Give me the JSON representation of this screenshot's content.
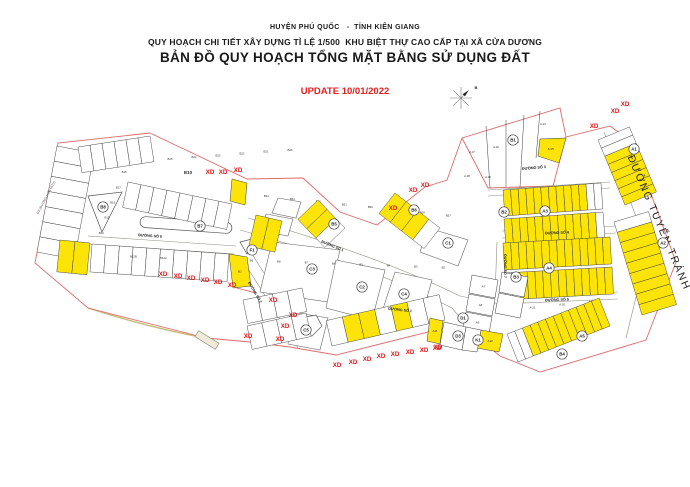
{
  "header": {
    "line1": "HUYỆN PHÚ QUỐC   -  TỈNH KIÊN GIANG",
    "line2": "QUY HOẠCH CHI TIẾT XÂY DỰNG TỈ LỆ 1/500  KHU BIỆT THỰ CAO CẤP TẠI XÃ CỬA DƯƠNG",
    "line3": "BẢN ĐỒ QUY HOẠCH TỔNG MẶT BẰNG SỬ DỤNG ĐẤT",
    "update": "UPDATE 10/01/2022"
  },
  "colors": {
    "boundary": "#e06a6a",
    "lot_stroke": "#3a3a3a",
    "yellow": "#fce408",
    "white_lot": "#ffffff",
    "xd": "#e01818",
    "road_edge": "#8f8f82",
    "update_red": "#e02020",
    "shore": "#c9bb78",
    "circle_stroke": "#444444",
    "label_dark": "#222222"
  },
  "map": {
    "boundaries": [
      "M150,133 L58,143 L35,263 L88,308 L206,338",
      "M206,338 L250,342 L290,347 L336,355 L448,327 L472,333 L500,356 L540,372 L646,340 L676,262 L632,142 L610,126",
      "M150,133 L247,179 L303,178 L340,212 L377,225 L425,187 L447,180 L462,138",
      "M462,138 L560,108 L566,137 L553,186 L488,188 L462,138",
      "M566,137 L610,126",
      "M233,287 L256,293"
    ],
    "shore": "M88,308 Q150,328 206,338",
    "road_edges": [
      "M88,236 L236,246",
      "M88,244 L234,254",
      "M248,218 C310,236 390,262 460,296",
      "M240,230 C305,248 382,272 452,308",
      "M488,190 L610,182",
      "M488,196 L610,188",
      "M502,231 L616,226",
      "M502,238 L616,233",
      "M500,297 L618,292",
      "M500,304 L618,299",
      "M240,256 L298,348",
      "M250,251 L308,342",
      "M497,242 L495,296",
      "M507,244 L505,298",
      "M604,132 L648,248 L626,338",
      "M460,296 L500,304",
      "M452,308 L470,330"
    ],
    "blocks": [
      {
        "pts": [
          [
            272,
            242
          ],
          [
            340,
            250
          ],
          [
            328,
            302
          ],
          [
            260,
            292
          ]
        ]
      },
      {
        "pts": [
          [
            336,
            260
          ],
          [
            385,
            270
          ],
          [
            372,
            320
          ],
          [
            326,
            308
          ]
        ]
      },
      {
        "pts": [
          [
            395,
            272
          ],
          [
            432,
            280
          ],
          [
            420,
            322
          ],
          [
            382,
            312
          ]
        ]
      },
      {
        "pts": [
          [
            428,
            228
          ],
          [
            468,
            240
          ],
          [
            458,
            266
          ],
          [
            420,
            252
          ]
        ]
      },
      {
        "pts": [
          [
            292,
            312
          ],
          [
            328,
            318
          ],
          [
            320,
            350
          ],
          [
            288,
            344
          ]
        ]
      },
      {
        "pts": [
          [
            278,
            198
          ],
          [
            301,
            202
          ],
          [
            296,
            218
          ],
          [
            272,
            213
          ]
        ]
      },
      {
        "pts": [
          [
            266,
            214
          ],
          [
            293,
            219
          ],
          [
            288,
            236
          ],
          [
            262,
            231
          ]
        ]
      }
    ],
    "islands": [
      {
        "pts": [
          [
            88,
            196
          ],
          [
            122,
            192
          ],
          [
            102,
            232
          ]
        ]
      },
      {
        "pts": [
          [
            240,
            242
          ],
          [
            252,
            239
          ],
          [
            247,
            254
          ]
        ]
      },
      {
        "pts": [
          [
            300,
            318
          ],
          [
            316,
            315
          ],
          [
            322,
            326
          ],
          [
            312,
            336
          ],
          [
            300,
            332
          ]
        ]
      }
    ],
    "oval_island": {
      "cx": 186,
      "cy": 225,
      "w": 92,
      "h": 11,
      "rot": 4
    },
    "pentagon_dividers": [
      [
        486,
        126,
        490,
        188
      ],
      [
        506,
        120,
        506,
        187
      ],
      [
        524,
        115,
        520,
        187
      ],
      [
        540,
        111,
        536,
        158
      ]
    ],
    "strips": [
      {
        "a": [
          57,
          146
        ],
        "b": [
          37,
          252
        ],
        "depth": -38,
        "count": 7,
        "yellows": [],
        "labels": [
          "B19",
          "B18",
          "B17",
          "B16",
          "B15",
          "B14",
          "B13"
        ]
      },
      {
        "a": [
          78,
          147
        ],
        "b": [
          150,
          136
        ],
        "depth": 26,
        "count": 6,
        "yellows": [],
        "labels": [
          "B25",
          "B24",
          "B23",
          "B22",
          "B21",
          "B20"
        ]
      },
      {
        "a": [
          128,
          182
        ],
        "b": [
          232,
          204
        ],
        "depth": 26,
        "count": 8,
        "yellows": [],
        "labels": [
          "B34",
          "B33",
          "B32",
          "B31",
          "B30",
          "B29",
          "B28",
          "B27"
        ]
      },
      {
        "a": [
          92,
          244
        ],
        "b": [
          229,
          254
        ],
        "depth": 28,
        "count": 10,
        "yellows": [],
        "labels": [
          "B11",
          "B10",
          "B9",
          "B8",
          "B7",
          "B6",
          "B5",
          "B4",
          "B3",
          "B2"
        ]
      },
      {
        "a": [
          60,
          240
        ],
        "b": [
          90,
          243
        ],
        "depth": 32,
        "count": 2,
        "yellows": [
          0,
          1
        ],
        "labels": [
          "B12B",
          "B12A"
        ]
      },
      {
        "a": [
          243,
          300
        ],
        "b": [
          302,
          288
        ],
        "depth": 24,
        "count": 4,
        "yellows": [],
        "labels": [
          "A.22",
          "A.21",
          "A.20",
          "A.19"
        ]
      },
      {
        "a": [
          247,
          326
        ],
        "b": [
          306,
          313
        ],
        "depth": 24,
        "count": 4,
        "yellows": [],
        "labels": [
          "A.26",
          "A.25",
          "A.24",
          "A.23"
        ]
      },
      {
        "a": [
          318,
          200
        ],
        "b": [
          345,
          228
        ],
        "depth": 28,
        "count": 3,
        "yellows": [
          0,
          1
        ],
        "labels": []
      },
      {
        "a": [
          395,
          193
        ],
        "b": [
          440,
          228
        ],
        "depth": 26,
        "count": 4,
        "yellows": [
          0,
          1,
          2
        ],
        "labels": []
      },
      {
        "a": [
          256,
          215
        ],
        "b": [
          282,
          221
        ],
        "depth": 32,
        "count": 2,
        "yellows": [
          0,
          1
        ],
        "labels": []
      },
      {
        "a": [
          598,
          140
        ],
        "b": [
          625,
          205
        ],
        "depth": -34,
        "count": 8,
        "yellows": [
          2,
          3,
          4,
          5,
          6,
          7
        ],
        "labels": []
      },
      {
        "a": [
          614,
          222
        ],
        "b": [
          642,
          315
        ],
        "depth": -36,
        "count": 9,
        "yellows": [
          1,
          2,
          3,
          4,
          5,
          6,
          7,
          8
        ],
        "labels": []
      },
      {
        "a": [
          503,
          190
        ],
        "b": [
          601,
          183
        ],
        "depth": 26,
        "count": 13,
        "yellows": [
          0,
          1,
          2,
          3,
          4,
          5,
          6,
          7,
          8,
          9,
          10
        ],
        "labels": []
      },
      {
        "a": [
          504,
          219
        ],
        "b": [
          603,
          212
        ],
        "depth": 26,
        "count": 13,
        "yellows": [
          0,
          1,
          2,
          3,
          4,
          5,
          6,
          7,
          8,
          9,
          10,
          11
        ],
        "labels": []
      },
      {
        "a": [
          503,
          243
        ],
        "b": [
          610,
          237
        ],
        "depth": 27,
        "count": 14,
        "yellows": "all",
        "labels": []
      },
      {
        "a": [
          504,
          273
        ],
        "b": [
          612,
          267
        ],
        "depth": 27,
        "count": 14,
        "yellows": [
          2,
          3,
          4,
          5,
          6,
          7,
          8,
          9,
          10,
          11,
          12,
          13
        ],
        "labels": []
      },
      {
        "a": [
          518,
          362
        ],
        "b": [
          610,
          326
        ],
        "depth": -30,
        "count": 12,
        "yellows": [
          2,
          3,
          4,
          5,
          6,
          7,
          8,
          9,
          10,
          11
        ],
        "labels": []
      },
      {
        "a": [
          332,
          346
        ],
        "b": [
          445,
          320
        ],
        "depth": -26,
        "count": 7,
        "yellows": [
          1,
          2,
          4
        ],
        "labels": []
      }
    ],
    "lots": [
      {
        "pts": [
          [
            472,
            275
          ],
          [
            498,
            280
          ],
          [
            495,
            298
          ],
          [
            469,
            293
          ]
        ],
        "fill": "white",
        "label": "A7"
      },
      {
        "pts": [
          [
            469,
            294
          ],
          [
            495,
            299
          ],
          [
            492,
            316
          ],
          [
            466,
            311
          ]
        ],
        "fill": "white",
        "label": "A8"
      },
      {
        "pts": [
          [
            466,
            312
          ],
          [
            492,
            317
          ],
          [
            489,
            333
          ],
          [
            463,
            328
          ]
        ],
        "fill": "white",
        "label": "A9"
      },
      {
        "pts": [
          [
            481,
            330
          ],
          [
            503,
            334
          ],
          [
            499,
            352
          ],
          [
            477,
            348
          ]
        ],
        "fill": "yellow",
        "label": "A10"
      },
      {
        "pts": [
          [
            444,
            322
          ],
          [
            466,
            327
          ],
          [
            462,
            350
          ],
          [
            440,
            345
          ]
        ],
        "fill": "white",
        "label": ""
      },
      {
        "pts": [
          [
            466,
            327
          ],
          [
            481,
            330
          ],
          [
            477,
            352
          ],
          [
            462,
            350
          ]
        ],
        "fill": "white",
        "label": ""
      },
      {
        "pts": [
          [
            502,
            272
          ],
          [
            528,
            277
          ],
          [
            524,
            297
          ],
          [
            499,
            292
          ]
        ],
        "fill": "white",
        "label": ""
      },
      {
        "pts": [
          [
            499,
            293
          ],
          [
            524,
            298
          ],
          [
            520,
            318
          ],
          [
            495,
            313
          ]
        ],
        "fill": "white",
        "label": ""
      },
      {
        "pts": [
          [
            229,
            254
          ],
          [
            247,
            257
          ],
          [
            251,
            286
          ],
          [
            233,
            288
          ]
        ],
        "fill": "yellow",
        "label": "B1"
      },
      {
        "pts": [
          [
            232,
            179
          ],
          [
            247,
            183
          ],
          [
            245,
            205
          ],
          [
            230,
            201
          ]
        ],
        "fill": "yellow",
        "label": ""
      },
      {
        "pts": [
          [
            540,
            139
          ],
          [
            566,
            138
          ],
          [
            559,
            163
          ],
          [
            538,
            156
          ]
        ],
        "fill": "yellow",
        "label": "A.05"
      },
      {
        "pts": [
          [
            430,
            318
          ],
          [
            443,
            321
          ],
          [
            440,
            344
          ],
          [
            427,
            341
          ]
        ],
        "fill": "yellow",
        "label": "A11"
      }
    ],
    "lot_labels": [
      {
        "x": 472,
        "y": 153,
        "t": "A.07"
      },
      {
        "x": 496,
        "y": 148,
        "t": "A.02"
      },
      {
        "x": 516,
        "y": 143,
        "t": "A.03"
      },
      {
        "x": 543,
        "y": 125,
        "t": "A.04"
      },
      {
        "x": 488,
        "y": 178,
        "t": "A.06"
      },
      {
        "x": 467,
        "y": 177,
        "t": "A.08"
      }
    ],
    "circle_labels": [
      {
        "x": 634,
        "y": 149,
        "t": "A1"
      },
      {
        "x": 663,
        "y": 243,
        "t": "A2"
      },
      {
        "x": 545,
        "y": 211,
        "t": "A3"
      },
      {
        "x": 549,
        "y": 268,
        "t": "A4"
      },
      {
        "x": 582,
        "y": 336,
        "t": "A5"
      },
      {
        "x": 513,
        "y": 140,
        "t": "B1"
      },
      {
        "x": 504,
        "y": 212,
        "t": "B2"
      },
      {
        "x": 516,
        "y": 277,
        "t": "B3"
      },
      {
        "x": 562,
        "y": 354,
        "t": "B4"
      },
      {
        "x": 334,
        "y": 224,
        "t": "B5"
      },
      {
        "x": 414,
        "y": 210,
        "t": "B6"
      },
      {
        "x": 200,
        "y": 226,
        "t": "B7"
      },
      {
        "x": 103,
        "y": 207,
        "t": "B8"
      },
      {
        "x": 448,
        "y": 243,
        "t": "C1"
      },
      {
        "x": 362,
        "y": 287,
        "t": "C2"
      },
      {
        "x": 312,
        "y": 269,
        "t": "C3"
      },
      {
        "x": 404,
        "y": 294,
        "t": "C4"
      },
      {
        "x": 306,
        "y": 330,
        "t": "C5"
      },
      {
        "x": 463,
        "y": 318,
        "t": "D1"
      },
      {
        "x": 458,
        "y": 336,
        "t": "D3"
      },
      {
        "x": 478,
        "y": 340,
        "t": "K1"
      },
      {
        "x": 252,
        "y": 250,
        "t": "F1"
      }
    ],
    "road_labels": [
      {
        "x": 150,
        "y": 237,
        "t": "ĐƯỜNG SỐ 6",
        "r": 4
      },
      {
        "x": 332,
        "y": 247,
        "t": "ĐƯỜNG SỐ 1",
        "r": 22
      },
      {
        "x": 400,
        "y": 311,
        "t": "ĐƯỜNG SỐ 1",
        "r": 6
      },
      {
        "x": 254,
        "y": 293,
        "t": "ĐƯỜNG SỐ 2",
        "r": 60
      },
      {
        "x": 534,
        "y": 169,
        "t": "ĐƯỜNG SỐ 3",
        "r": -5
      },
      {
        "x": 557,
        "y": 234,
        "t": "ĐƯỜNG SỐ 4",
        "r": -2
      },
      {
        "x": 557,
        "y": 301,
        "t": "ĐƯỜNG SỐ 5",
        "r": -2
      },
      {
        "x": 504,
        "y": 266,
        "t": "ĐƯỜNG SỐ 7",
        "r": 90
      }
    ],
    "text_labels": [
      {
        "x": 188,
        "y": 174,
        "t": "B10",
        "size": 4.5,
        "rot": 0,
        "ls": 0,
        "color": "#333333",
        "bold": true
      },
      {
        "x": 656,
        "y": 224,
        "t": "ĐƯỜNG TUYẾN TRÁNH",
        "size": 10.5,
        "rot": 67,
        "ls": 1.6,
        "color": "#222222",
        "bold": false
      },
      {
        "x": 47,
        "y": 198,
        "t": "ĐX (ĐƯỜNG HIỆN HỮU)",
        "size": 3.2,
        "rot": -62,
        "ls": 0,
        "color": "#555555",
        "bold": false
      }
    ],
    "xd_labels": [
      {
        "x": 210,
        "y": 174
      },
      {
        "x": 223,
        "y": 174
      },
      {
        "x": 238,
        "y": 172
      },
      {
        "x": 594,
        "y": 128
      },
      {
        "x": 615,
        "y": 113
      },
      {
        "x": 625,
        "y": 106
      },
      {
        "x": 393,
        "y": 210
      },
      {
        "x": 413,
        "y": 192
      },
      {
        "x": 425,
        "y": 187
      },
      {
        "x": 163,
        "y": 276
      },
      {
        "x": 178,
        "y": 278
      },
      {
        "x": 191,
        "y": 280
      },
      {
        "x": 205,
        "y": 282
      },
      {
        "x": 218,
        "y": 284
      },
      {
        "x": 232,
        "y": 287
      },
      {
        "x": 273,
        "y": 302
      },
      {
        "x": 293,
        "y": 317
      },
      {
        "x": 285,
        "y": 328
      },
      {
        "x": 248,
        "y": 338
      },
      {
        "x": 280,
        "y": 341
      },
      {
        "x": 337,
        "y": 367
      },
      {
        "x": 353,
        "y": 364
      },
      {
        "x": 367,
        "y": 361
      },
      {
        "x": 381,
        "y": 358
      },
      {
        "x": 395,
        "y": 356
      },
      {
        "x": 410,
        "y": 354
      },
      {
        "x": 424,
        "y": 352
      },
      {
        "x": 438,
        "y": 349
      },
      {
        "x": 437,
        "y": 350
      }
    ],
    "xd_text": "XD",
    "compass": {
      "cx": 461,
      "cy": 98,
      "r": 11,
      "north_label": "B"
    },
    "pier": {
      "cx": 207,
      "cy": 340,
      "w": 24,
      "h": 7,
      "rot": 32
    }
  }
}
